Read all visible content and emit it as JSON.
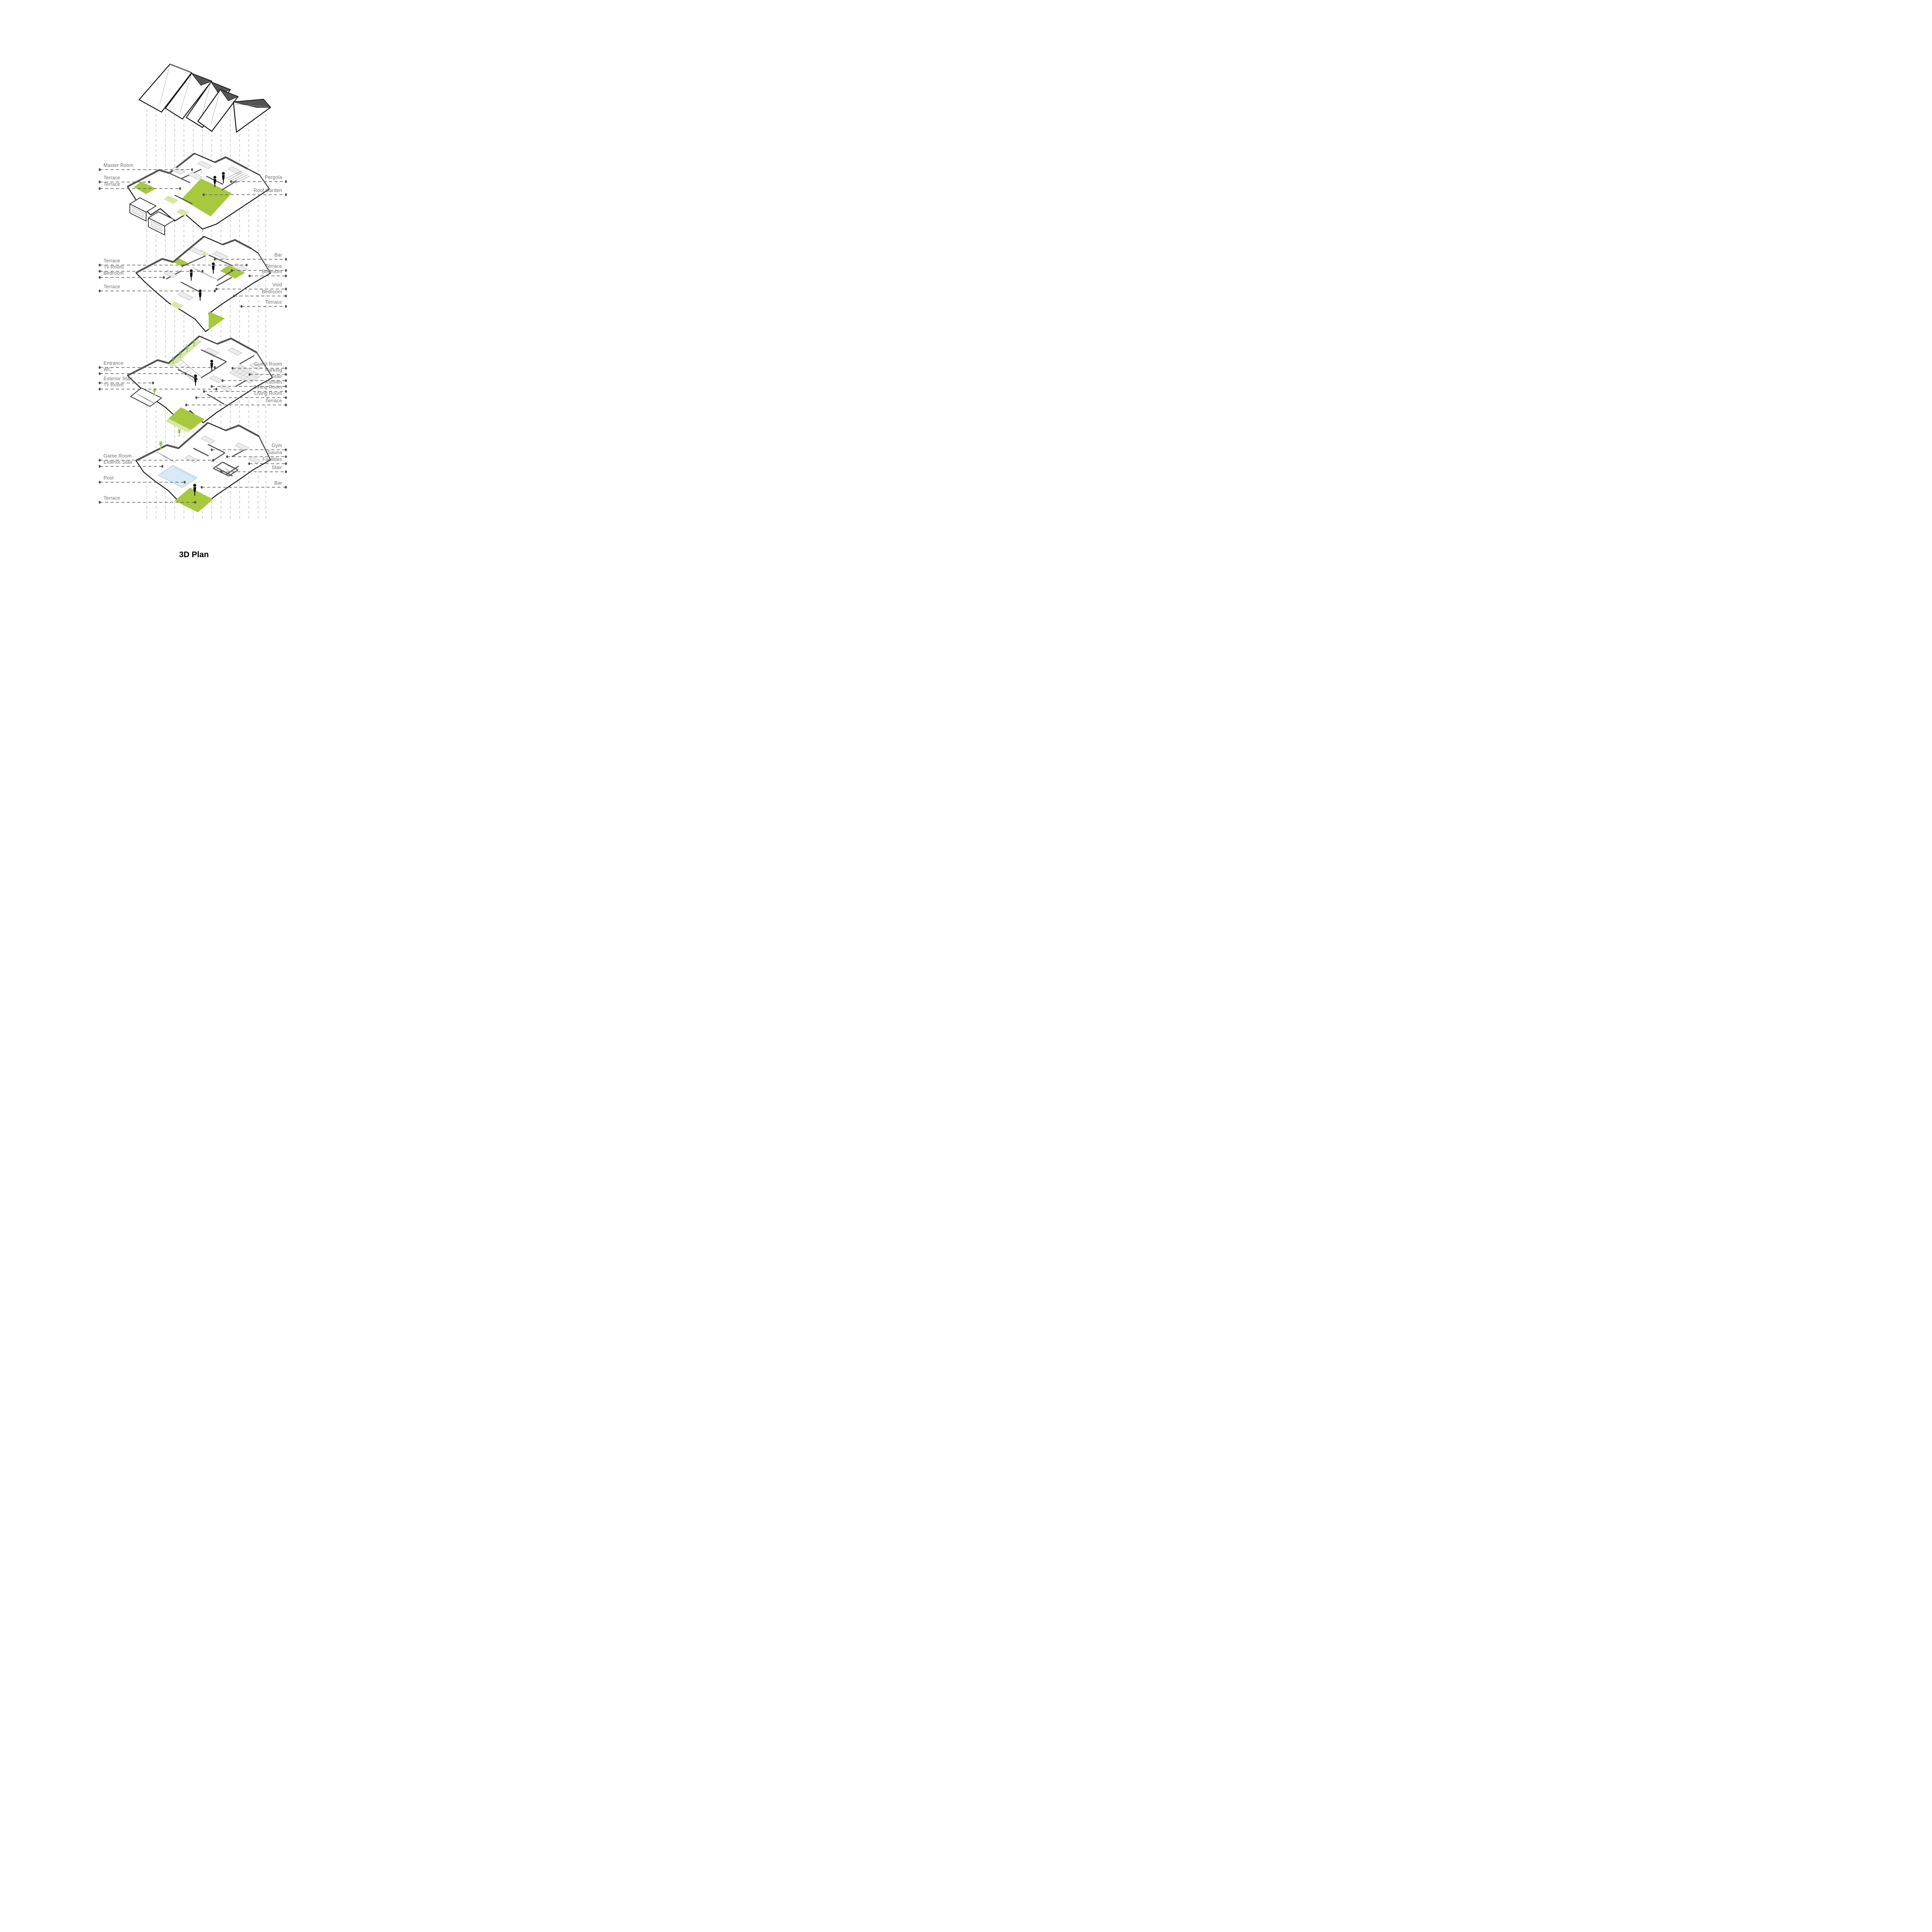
{
  "title": "3D Plan",
  "colors": {
    "accent_green": "#a7c93e",
    "light_green": "#d8e7a6",
    "pool_blue": "#d7eaf6",
    "wall_cap_gray": "#545454",
    "outline_ink": "#161616",
    "label_gray": "#6e6e6e",
    "background": "#ffffff"
  },
  "icons": {
    "person": "standing-human-silhouette",
    "plant": "small-tree-sprig"
  },
  "levels": [
    {
      "id": "roof-plates",
      "left_labels": [],
      "right_labels": []
    },
    {
      "id": "master-floor",
      "left_labels": [
        "Master Room",
        "Terrace",
        "Terrace"
      ],
      "right_labels": [
        "Pergola",
        "Roof Garden"
      ]
    },
    {
      "id": "bedroom-floor",
      "left_labels": [
        "Terrace",
        "Tv Room",
        "Bedroom",
        "Terrace"
      ],
      "right_labels": [
        "Bar",
        "Terrace",
        "Bedroom",
        "Void",
        "Bedroom",
        "Terrace"
      ]
    },
    {
      "id": "main-floor",
      "left_labels": [
        "Entrance",
        "WC",
        "Exterior Stair",
        "Tv Room"
      ],
      "right_labels": [
        "Guest Room",
        "Parking",
        "Stair",
        "Kitchen",
        "Dining Room",
        "Living Room",
        "Terrace"
      ]
    },
    {
      "id": "basement-floor",
      "left_labels": [
        "Game Room",
        "Exterior Stair",
        "Pool",
        "Terrace"
      ],
      "right_labels": [
        "Gym",
        "Sauna",
        "Facilities",
        "Stair",
        "Bar"
      ]
    }
  ]
}
